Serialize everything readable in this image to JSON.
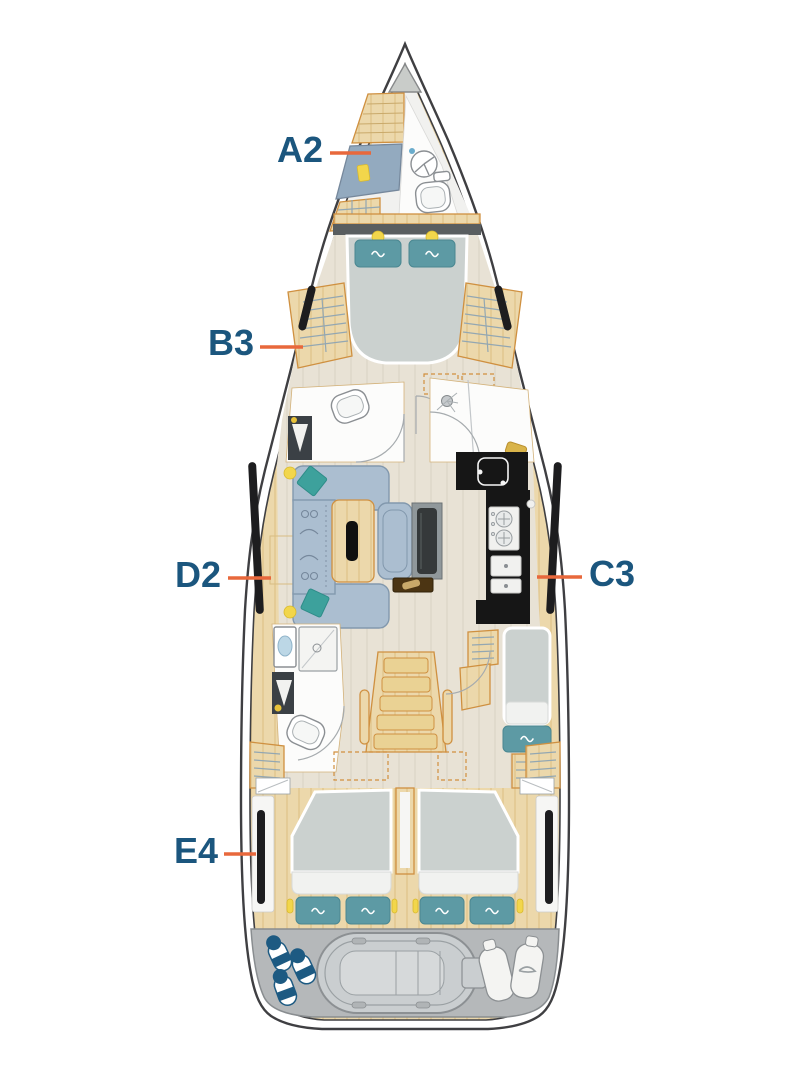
{
  "plan": {
    "labels": [
      {
        "text": "A2",
        "points_to": "bow-crew-cabin-berth"
      },
      {
        "text": "B3",
        "points_to": "forward-cabin-wardrobe-port"
      },
      {
        "text": "D2",
        "points_to": "salon-sideboard-port"
      },
      {
        "text": "C3",
        "points_to": "galley-starboard"
      },
      {
        "text": "E4",
        "points_to": "aft-cabin-hull-window-port"
      }
    ]
  },
  "colors": {
    "label_text": "#1b567e",
    "leader_line": "#e8683c",
    "hull_outline": "#3f3f42",
    "wood": "#ecd8ab",
    "wood_outline": "#cf9040",
    "floor": "#e8e2d5",
    "mattress": "#cbd1cf",
    "pillow_teal": "#5d9aa4",
    "sofa_blue": "#abbed0",
    "cushion_teal": "#3da19c",
    "galley_black": "#161616",
    "stern_gray": "#b5b8ba",
    "fender_navy": "#1d5a82",
    "lamp_yellow": "#f2d64b",
    "crew_bed_blue": "#93aabf"
  }
}
